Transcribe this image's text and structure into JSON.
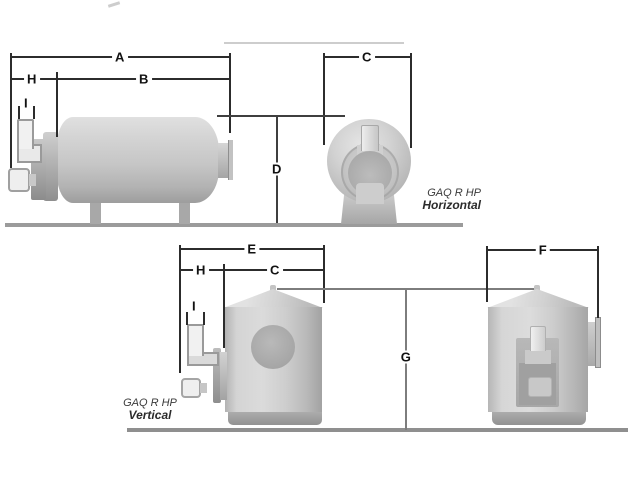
{
  "diagram": {
    "horizontal": {
      "caption_line1": "GAQ R HP",
      "caption_line2": "Horizontal",
      "labels": {
        "a": "A",
        "b": "B",
        "c": "C",
        "d": "D",
        "h": "H",
        "i": "I"
      }
    },
    "vertical": {
      "caption_line1": "GAQ R HP",
      "caption_line2": "Vertical",
      "labels": {
        "e": "E",
        "f": "F",
        "g": "G",
        "c": "C",
        "h": "H",
        "i": "I"
      }
    },
    "colors": {
      "dimension_line": "#2c2c2c",
      "secondary_line": "#7d7d7d",
      "metal_light": "#dadada",
      "metal_dark": "#a2a2a2",
      "ground": "#969696",
      "label_text": "#111111",
      "caption_text": "#333333"
    }
  }
}
